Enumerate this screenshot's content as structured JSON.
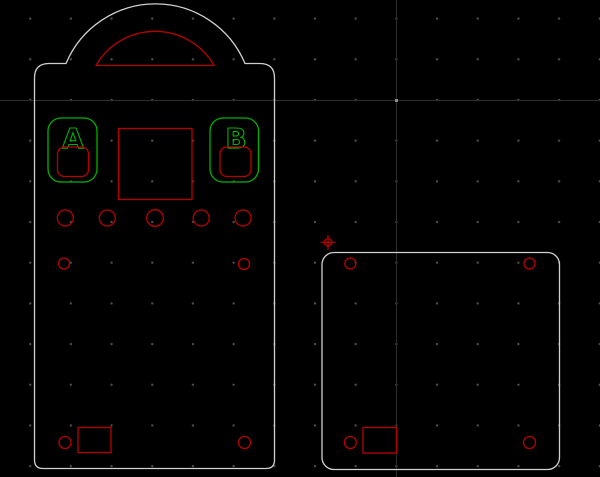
{
  "canvas": {
    "background_color": "#000000",
    "grid": {
      "dot_color": "#4d4d4d",
      "spacing_px": 40.7
    },
    "axes": {
      "line_color": "#2e2e2e",
      "cross_x": 396,
      "cross_y": 100
    }
  },
  "colors": {
    "part_outline": "#d0d0d0",
    "cut_feature": "#b80000",
    "engrave_feature": "#00b200"
  },
  "left_part": {
    "button_a_label": "A",
    "button_b_label": "B",
    "top_circle_count": 5,
    "mid_circle_count": 2,
    "bottom_circle_count": 2
  },
  "right_part": {
    "corner_hole_count": 4
  },
  "origin_marker": {
    "color": "#b80000"
  }
}
